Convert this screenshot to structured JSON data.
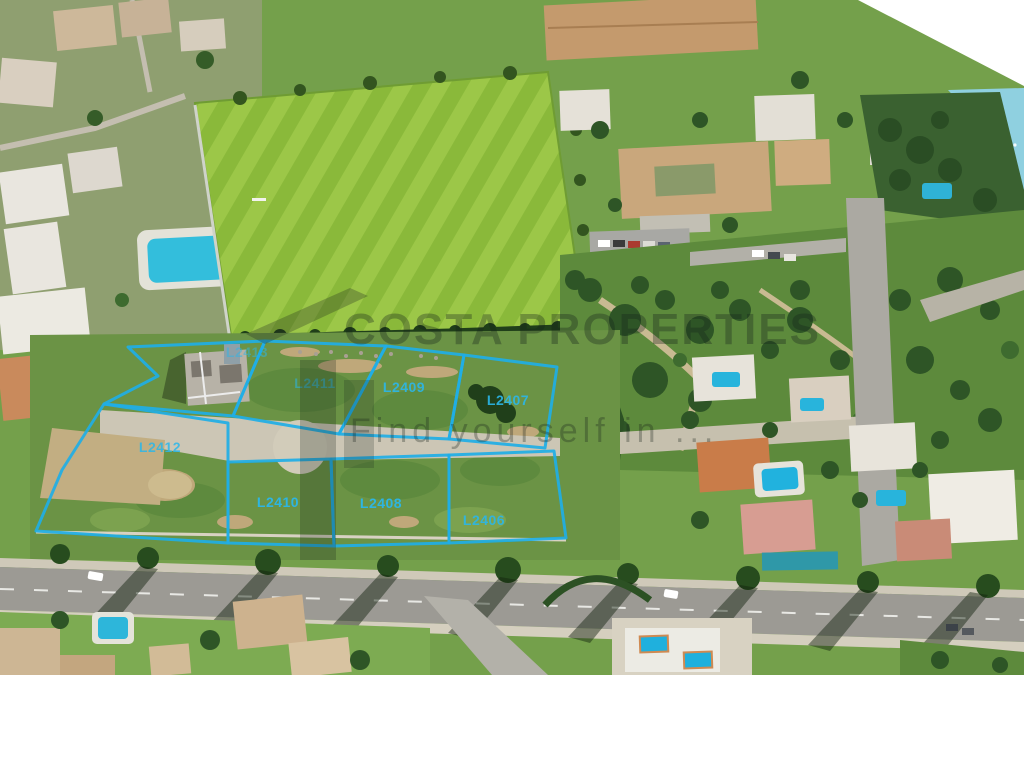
{
  "scene": {
    "description": "Aerial drone photograph of a coastal resort area: striped green sports field, resort buildings with tan roofs, villas with swimming pools, roads with tree shadows, sea in the top-right corner, and eight vacant building plots outlined in cyan",
    "ocean_color": "#8fd0e0",
    "field_color": "#98c344",
    "photo_bottom_margin_color": "#ffffff"
  },
  "watermark": {
    "brand": "COSTA PROPERTIES",
    "tagline": "Find yourself in ...",
    "logo": "house-outline-icon"
  },
  "plot_overlay": {
    "color": "#1FAEE6",
    "label_color": "#2BB7EA",
    "plots": [
      {
        "id": "L2413",
        "points": "128,347 265,341 233,416 104,404 158,376",
        "label_x": 247,
        "label_y": 357,
        "label_opacity": 0.5
      },
      {
        "id": "L2411",
        "points": "265,341 386,346 339,434 233,416",
        "label_x": 315,
        "label_y": 388,
        "label_opacity": 0.55
      },
      {
        "id": "L2409",
        "points": "386,346 464,355 449,439 339,434",
        "label_x": 404,
        "label_y": 392,
        "label_opacity": 0.9
      },
      {
        "id": "L2407",
        "points": "464,355 557,367 545,448 449,439",
        "label_x": 508,
        "label_y": 405,
        "label_opacity": 0.9
      },
      {
        "id": "L2412",
        "points": "104,404 228,423 228,543 36,531 62,470",
        "label_x": 160,
        "label_y": 452,
        "label_opacity": 0.85
      },
      {
        "id": "L2410",
        "points": "228,462 331,459 334,546 228,543",
        "label_x": 278,
        "label_y": 507,
        "label_opacity": 0.95
      },
      {
        "id": "L2408",
        "points": "331,459 449,455 449,543 334,546",
        "label_x": 381,
        "label_y": 508,
        "label_opacity": 0.95
      },
      {
        "id": "L2406",
        "points": "449,455 554,451 566,538 449,543",
        "label_x": 484,
        "label_y": 525,
        "label_opacity": 0.9
      }
    ]
  }
}
